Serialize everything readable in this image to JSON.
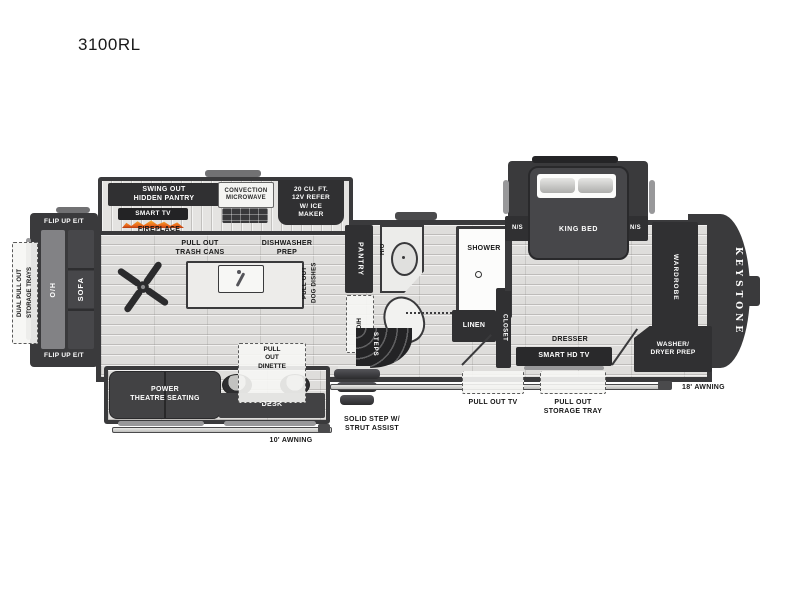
{
  "title": "3100RL",
  "kitchen": {
    "hidden_pantry": "SWING OUT\nHIDDEN PANTRY",
    "smart_tv": "SMART TV",
    "fireplace": "FIREPLACE",
    "microwave": "CONVECTION\nMICROWAVE",
    "refer": "20 CU. FT.\n12V REFER\nW/ ICE\nMAKER",
    "trash_cans": "PULL OUT\nTRASH CANS",
    "dishwasher": "DISHWASHER\nPREP",
    "dog_dishes": "PULL OUT\nDOG DISHES",
    "pantry": "PANTRY",
    "pantry_oh": "O/H"
  },
  "living": {
    "flip_up_top": "FLIP UP E/T",
    "flip_up_bottom": "FLIP UP E/T",
    "sofa_oh": "O/H",
    "sofa": "SOFA",
    "storage_trays": "DUAL PULL OUT\nSTORAGE TRAYS",
    "theatre": "POWER\nTHEATRE SEATING",
    "desk": "DESK",
    "dinette": "PULL\nOUT\nDINETTE",
    "awning_10": "10' AWNING"
  },
  "bath": {
    "sink_ho": "H/O",
    "shower": "SHOWER",
    "linen": "LINEN",
    "closet": "CLOSET",
    "steps": "STEPS"
  },
  "bedroom": {
    "king_bed": "KING BED",
    "ns_left": "N/S",
    "ns_right": "N/S",
    "dresser": "DRESSER",
    "smart_hd_tv": "SMART HD TV",
    "wardrobe": "WARDROBE",
    "washer_dryer": "WASHER/\nDRYER PREP"
  },
  "exterior": {
    "brand": "KEYSTONE",
    "solid_step": "SOLID STEP W/\nSTRUT ASSIST",
    "pull_out_tv": "PULL OUT TV",
    "storage_tray": "PULL OUT\nSTORAGE TRAY",
    "awning_18": "18' AWNING"
  },
  "colors": {
    "wall": "#3a3a3c",
    "box": "#303032",
    "flame": "#e8641b"
  }
}
